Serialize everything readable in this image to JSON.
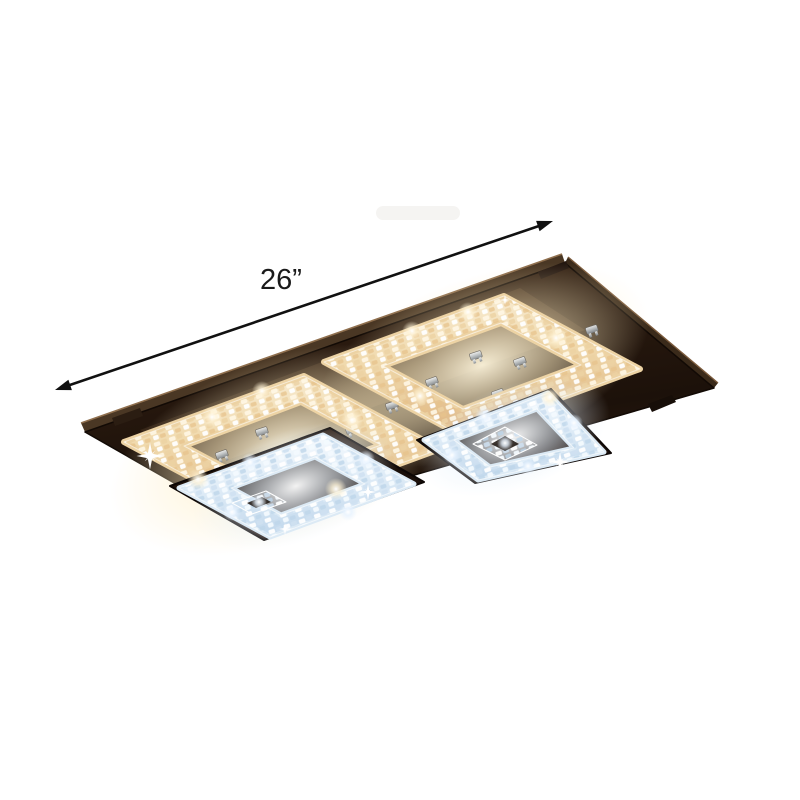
{
  "image": {
    "alt": "Crystal LED flush mount ceiling light with a rectangular dark stainless-steel canopy and two square tiered crystal shades, each with a warm-lit outer crystal ring, a cool-white inner crystal tier and a small center crystal, annotated with a diagonal double-headed arrow marking a 26 inch width",
    "background": "#ffffff"
  },
  "annotation": {
    "dimension_label": "26”",
    "dimension_value": 26,
    "dimension_unit": "in"
  },
  "colors": {
    "background": "#ffffff",
    "arrow": "#111111",
    "label": "#1a1a1a",
    "plate_dark": "#1c110a",
    "plate_mid": "#44301f",
    "plate_edge_highlight": "#8f6f4e",
    "warm_crystal": "#f6e8cc",
    "warm_crystal_deep": "#e0b987",
    "cool_crystal": "#f2f8fd",
    "cool_crystal_deep": "#c9dced",
    "chrome": "#d6dadd",
    "glow_warm": "#ffeecb",
    "glow_cool": "#eaf4ff"
  }
}
